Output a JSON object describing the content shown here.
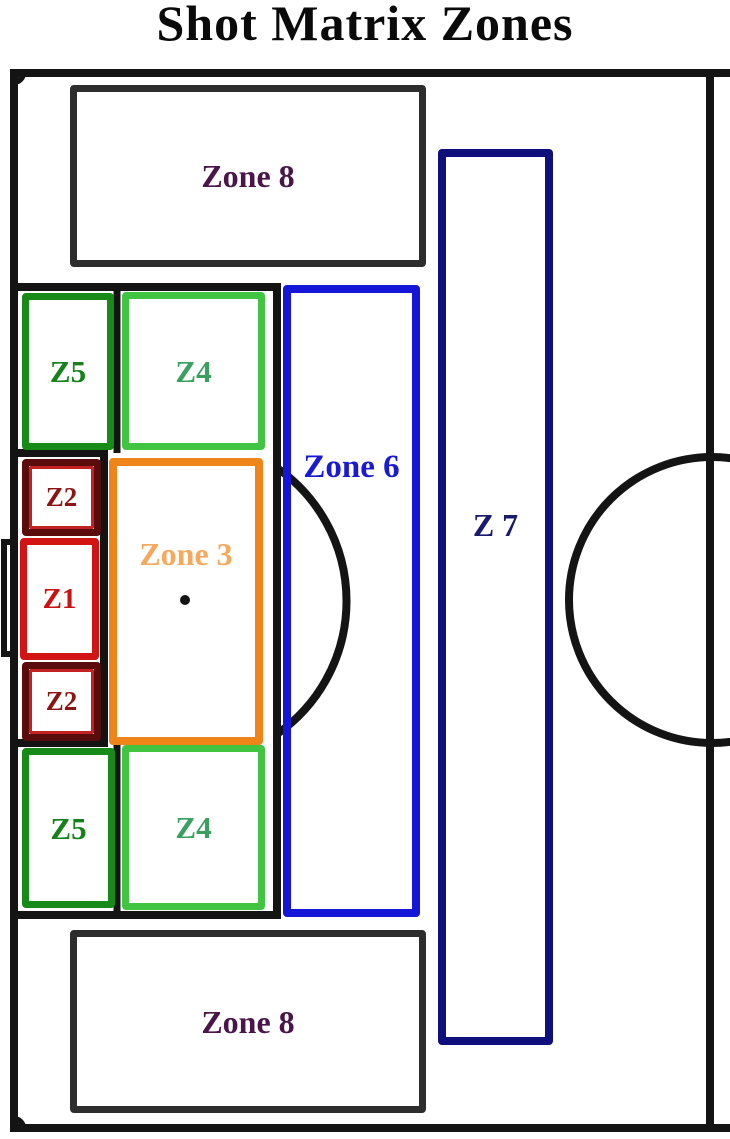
{
  "title": "Shot Matrix Zones",
  "colors": {
    "background": "#ffffff",
    "pitch_line": "#141414"
  },
  "zones": [
    {
      "id": "zone8-top",
      "label": "Zone 8",
      "border_color": "#2d2d2d",
      "label_color": "#4a164a"
    },
    {
      "id": "z5-top",
      "label": "Z5",
      "border_color": "#178a17",
      "label_color": "#17821c"
    },
    {
      "id": "z4-top",
      "label": "Z4",
      "border_color": "#41c441",
      "label_color": "#3aa060"
    },
    {
      "id": "z2-top",
      "label": "Z2",
      "border_color": "#5a0b0b",
      "inner_border_color": "#c32222",
      "label_color": "#8c1414"
    },
    {
      "id": "z1",
      "label": "Z1",
      "border_color": "#d31414",
      "label_color": "#c81313"
    },
    {
      "id": "z2-bottom",
      "label": "Z2",
      "border_color": "#5a0b0b",
      "inner_border_color": "#c32222",
      "label_color": "#8c1414"
    },
    {
      "id": "zone3",
      "label": "Zone 3",
      "border_color": "#ef8418",
      "label_color": "#f5a95d"
    },
    {
      "id": "z5-bottom",
      "label": "Z5",
      "border_color": "#178a17",
      "label_color": "#17821c"
    },
    {
      "id": "z4-bottom",
      "label": "Z4",
      "border_color": "#41c441",
      "label_color": "#3aa060"
    },
    {
      "id": "zone6",
      "label": "Zone 6",
      "border_color": "#1616d8",
      "label_color": "#1a1ad0"
    },
    {
      "id": "zone7",
      "label": "Z 7",
      "border_color": "#10107d",
      "label_color": "#1b1b6e"
    },
    {
      "id": "zone8-bottom",
      "label": "Zone 8",
      "border_color": "#2d2d2d",
      "label_color": "#4a164a"
    }
  ]
}
